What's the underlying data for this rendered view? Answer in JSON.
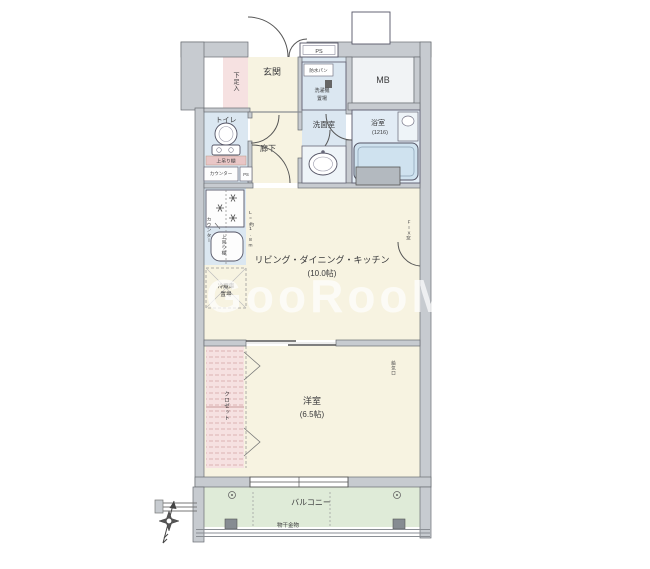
{
  "watermark": "GooRooM",
  "t": {
    "genkan": "玄関",
    "shoe_box": "下足入",
    "ps_top": "PS",
    "mb": "MB",
    "toilet": "トイレ",
    "toilet_shelf": "上吊り棚",
    "toilet_counter": "カウンター",
    "toilet_ps": "PS",
    "hallway": "廊下",
    "washroom": "洗面室",
    "waterproof_pan": "防水パン",
    "laundry_1": "洗濯機",
    "laundry_2": "置場",
    "bathroom": "浴室",
    "bathroom_size": "(1216)",
    "kitchen_counter": "カウンター",
    "kitchen_shelf": "上吊り棚",
    "kitchen_length": "L=約1.8m",
    "fridge_1": "冷蔵庫",
    "fridge_2": "置場",
    "ldk": "リビング・ダイニング・キッチン",
    "ldk_size": "(10.0帖)",
    "fix_window": "FIX窓",
    "western": "洋室",
    "western_size": "(6.5帖)",
    "closet": "クロゼット",
    "vent": "給気口",
    "balcony": "バルコニー",
    "drying_fixture": "物干金物"
  },
  "colors": {
    "wall": "#c7cbd0",
    "cream": "#f7f3e1",
    "blue": "#dbe7f1",
    "blue2": "#e2ecf5",
    "pink": "#f6e1e1",
    "green": "#dfebd8",
    "mbbox": "#f1f3f5",
    "tub": "#cfe2ef",
    "heater": "#b3b9bf",
    "watermark": "#ffffff"
  }
}
